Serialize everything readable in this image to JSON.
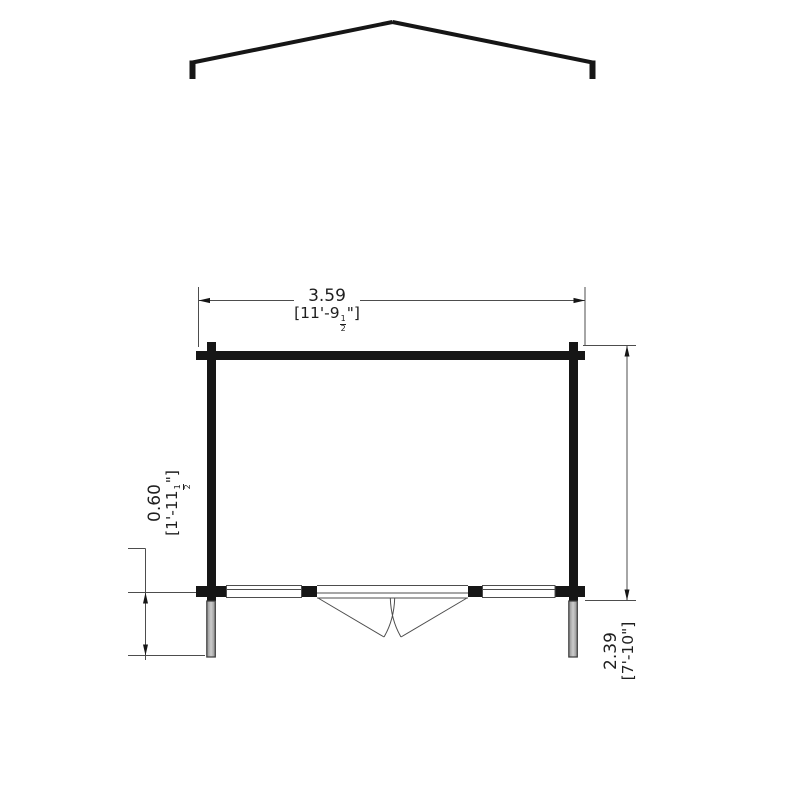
{
  "drawing": {
    "type": "garden-building-dimension-plan",
    "labels": {
      "width_metric": "3.59",
      "width_imperial_pre": "[11'-9",
      "width_frac_num": "1",
      "width_frac_den": "2",
      "width_imperial_post": "\"]",
      "overhang_metric": "0.60",
      "overhang_imperial_pre": "[1'-11",
      "overhang_frac_num": "1",
      "overhang_frac_den": "2",
      "overhang_imperial_post": "\"]",
      "depth_metric": "2.39",
      "depth_imperial": "[7'-10\"]"
    },
    "colors": {
      "wall_line": "#161616",
      "thin_line": "#4d4d4d",
      "post_fill_light": "#cccccc",
      "post_fill_dark": "#8f8f8f",
      "background": "#ffffff"
    }
  }
}
